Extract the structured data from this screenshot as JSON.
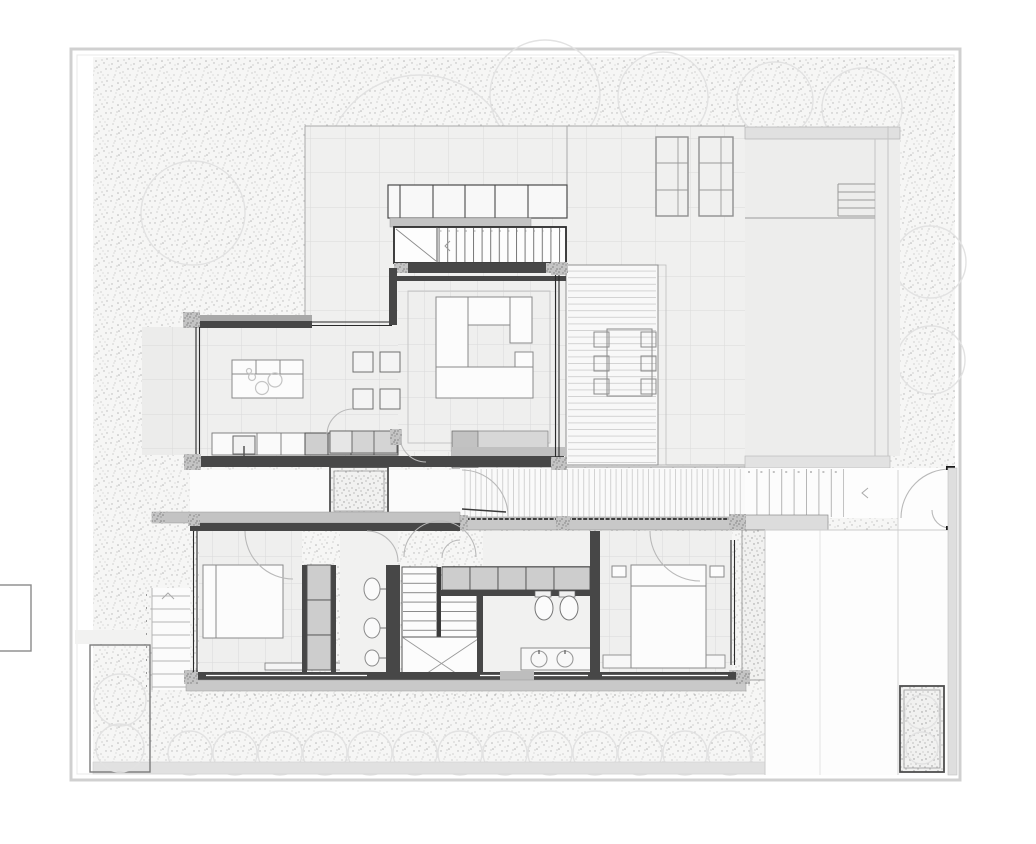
{
  "meta": {
    "type": "architectural-floor-plan",
    "level": "ground-floor",
    "canvas": {
      "width": 1036,
      "height": 844
    },
    "visible_text": "none"
  },
  "colors": {
    "paper": "#ffffff",
    "boundary": "#d0d0d0",
    "gardenbg": "#f6f6f5",
    "gardendot": "#9f9f9f",
    "tilebg": "#f0f0ef",
    "tileline": "#dadada",
    "interior": "#efefee",
    "wall": "#474747",
    "wallgray": "#c3c3c3",
    "glass": "#2a2a2a",
    "furnstroke": "#8a8a8a",
    "furnfill": "#fcfcfc",
    "grayunit": "#cdcdcd",
    "grayunitstroke": "#4f4f4f",
    "deckline": "#cfcfcf",
    "arc": "#b9b9b9",
    "tree": "#e2e2e2",
    "band": "#e1e1e1",
    "court": "#ededec"
  },
  "elements": {
    "rooms": [
      "garden",
      "terrace",
      "upper-courtyard",
      "living-room",
      "kitchen",
      "dining-area",
      "entry-courtyard",
      "walkway",
      "outdoor-deck",
      "bedroom-1",
      "bathroom-1",
      "staircase-lower",
      "dressing-area",
      "bathroom-2",
      "bedroom-2",
      "driveway"
    ],
    "furniture": [
      "sectional-sofa",
      "sideboard",
      "kitchen-island",
      "dining-table-chairs",
      "outdoor-dining-set",
      "bed-1",
      "bed-2",
      "wardrobe-units",
      "toilets",
      "twin-sink-vanity",
      "bench"
    ],
    "site_features": [
      "property-boundary",
      "shrub-row",
      "tree-canopies",
      "skylights",
      "upper-staircase",
      "garden-steps",
      "west-planter-bed",
      "hall-planter",
      "driveway-planter",
      "entry-gate",
      "garage-steps"
    ]
  }
}
